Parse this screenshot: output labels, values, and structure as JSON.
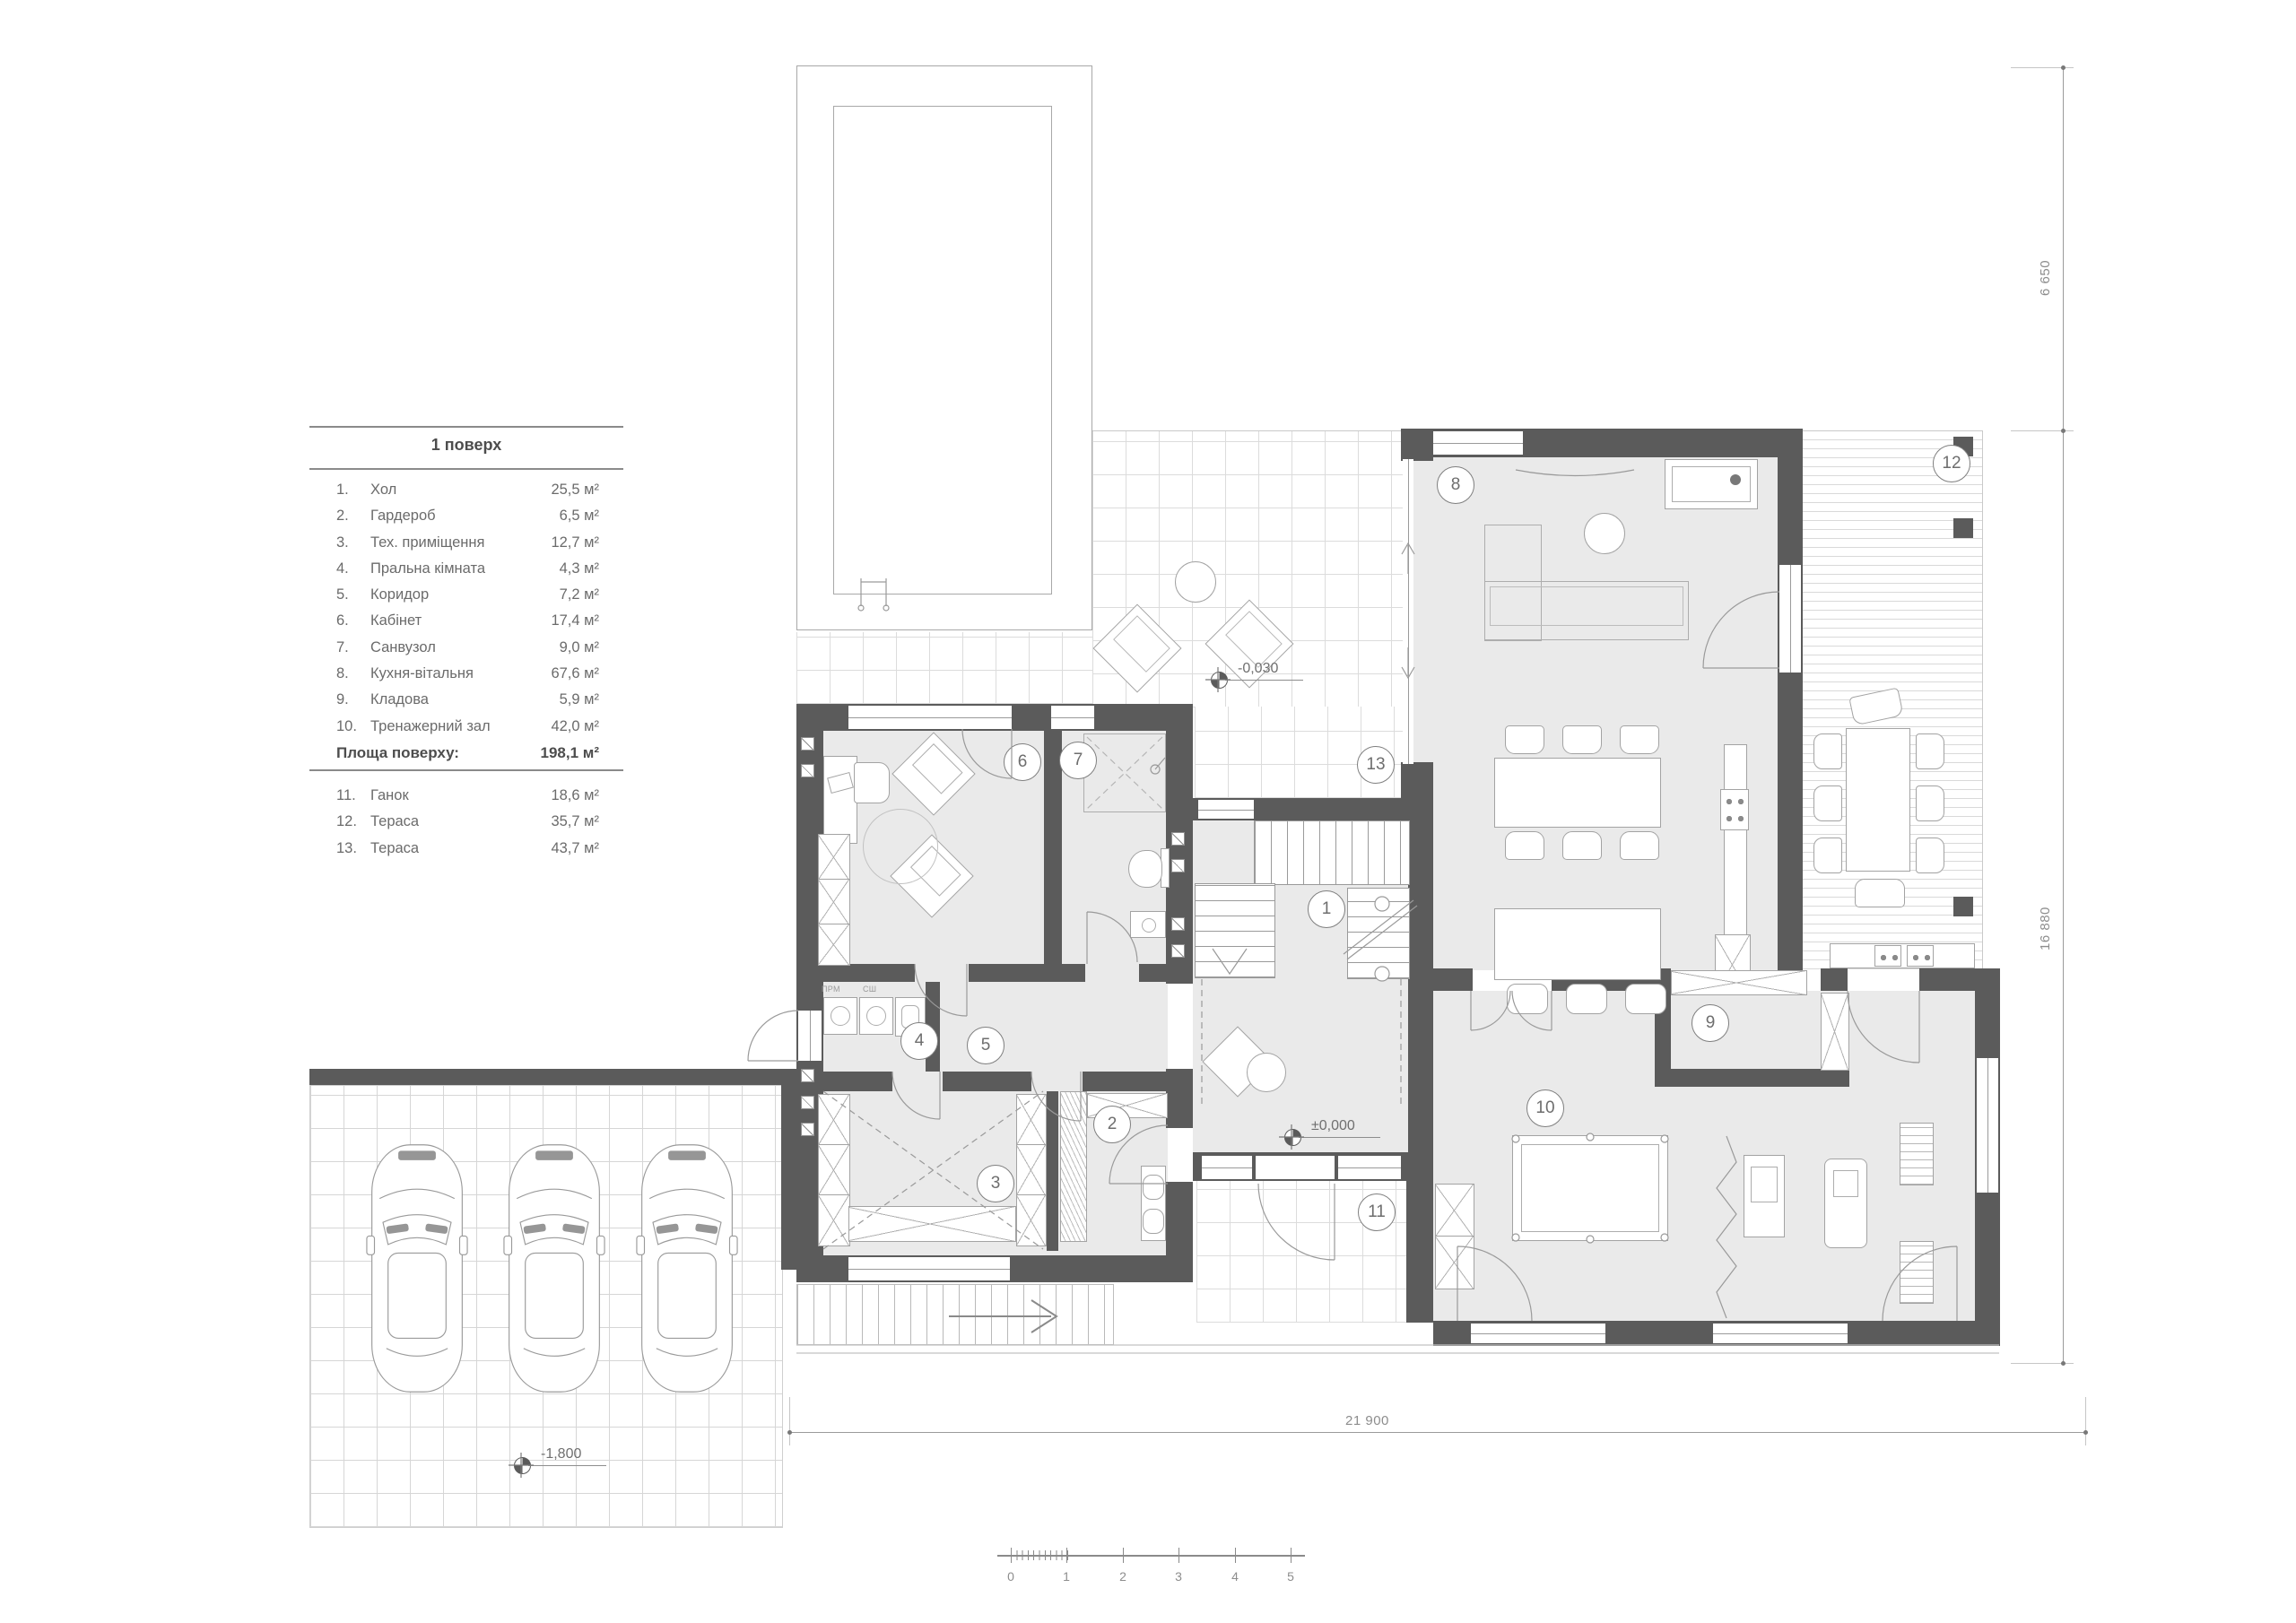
{
  "legend": {
    "title": "1 поверх",
    "rooms": [
      {
        "num": "1.",
        "name": "Хол",
        "area": "25,5 м²"
      },
      {
        "num": "2.",
        "name": "Гардероб",
        "area": "6,5 м²"
      },
      {
        "num": "3.",
        "name": "Тех. приміщення",
        "area": "12,7 м²"
      },
      {
        "num": "4.",
        "name": "Пральна кімната",
        "area": "4,3 м²"
      },
      {
        "num": "5.",
        "name": "Коридор",
        "area": "7,2 м²"
      },
      {
        "num": "6.",
        "name": "Кабінет",
        "area": "17,4 м²"
      },
      {
        "num": "7.",
        "name": "Санвузол",
        "area": "9,0 м²"
      },
      {
        "num": "8.",
        "name": "Кухня-вітальня",
        "area": "67,6 м²"
      },
      {
        "num": "9.",
        "name": "Кладова",
        "area": "5,9 м²"
      },
      {
        "num": "10.",
        "name": "Тренажерний зал",
        "area": "42,0 м²"
      }
    ],
    "total_label": "Площа поверху:",
    "total_area": "198,1 м²",
    "outdoor": [
      {
        "num": "11.",
        "name": "Ганок",
        "area": "18,6 м²"
      },
      {
        "num": "12.",
        "name": "Тераса",
        "area": "35,7 м²"
      },
      {
        "num": "13.",
        "name": "Тераса",
        "area": "43,7 м²"
      }
    ]
  },
  "dimensions": {
    "right_top": "6 650",
    "right_main": "16 880",
    "bottom": "21 900"
  },
  "levels": {
    "terrace": "-0,030",
    "ground": "±0,000",
    "parking": "-1,800"
  },
  "scale_bar": {
    "labels": [
      "0",
      "1",
      "2",
      "3",
      "4",
      "5"
    ]
  },
  "room_markers": {
    "r1": "1",
    "r2": "2",
    "r3": "3",
    "r4": "4",
    "r5": "5",
    "r6": "6",
    "r7": "7",
    "r8": "8",
    "r9": "9",
    "r10": "10",
    "r11": "11",
    "r12": "12",
    "r13": "13"
  },
  "labels": {
    "washer": "ПРМ",
    "dryer": "СШ"
  },
  "colors": {
    "wall": "#5b5b5b",
    "floor": "#eaeaea",
    "line": "#9a9a9a",
    "text": "#6b6b6b"
  }
}
